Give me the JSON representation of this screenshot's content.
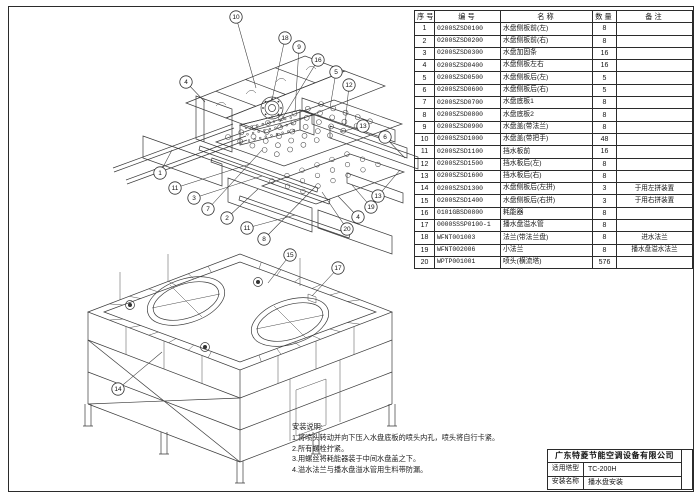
{
  "bom_table": {
    "headers": [
      "序号",
      "编号",
      "名称",
      "数量",
      "备注"
    ],
    "rows": [
      [
        "1",
        "0200SZSD0100",
        "水盘侧板前(左)",
        "8",
        ""
      ],
      [
        "2",
        "0200SZSD0200",
        "水盘侧板前(右)",
        "8",
        ""
      ],
      [
        "3",
        "0200SZSD0300",
        "水盘加固条",
        "16",
        ""
      ],
      [
        "4",
        "0200SZSD0400",
        "水盘侧板左右",
        "16",
        ""
      ],
      [
        "5",
        "0200SZSD0500",
        "水盘侧板后(左)",
        "5",
        ""
      ],
      [
        "6",
        "0200SZSD0600",
        "水盘侧板后(右)",
        "5",
        ""
      ],
      [
        "7",
        "0200SZSD0700",
        "水盘底板1",
        "8",
        ""
      ],
      [
        "8",
        "0200SZSD0800",
        "水盘底板2",
        "8",
        ""
      ],
      [
        "9",
        "0200SZSD0900",
        "水盘盖(带法兰)",
        "8",
        ""
      ],
      [
        "10",
        "0200SZSD1000",
        "水盘盖(带把手)",
        "48",
        ""
      ],
      [
        "11",
        "0200SZSD1100",
        "挡水板前",
        "16",
        ""
      ],
      [
        "12",
        "0200SZSD1500",
        "挡水板后(左)",
        "8",
        ""
      ],
      [
        "13",
        "0200SZSD1600",
        "挡水板后(右)",
        "8",
        ""
      ],
      [
        "14",
        "0200SZSD1300",
        "水盘侧板后(左拼)",
        "3",
        "于用左拼装置"
      ],
      [
        "15",
        "0200SZSD1400",
        "水盘侧板后(右拼)",
        "3",
        "于用右拼装置"
      ],
      [
        "16",
        "0101GBSD0800",
        "耗能器",
        "8",
        ""
      ],
      [
        "17",
        "0000SSSP0100-1",
        "播水盘溢水管",
        "8",
        ""
      ],
      [
        "18",
        "WFNT001003",
        "法兰(带法兰盘)",
        "8",
        "进水法兰"
      ],
      [
        "19",
        "WFNT002006",
        "小法兰",
        "8",
        "播水盘溢水法兰"
      ],
      [
        "20",
        "WPTP001001",
        "喷头(横流塔)",
        "576",
        ""
      ]
    ]
  },
  "notes": {
    "title": "安装说明:",
    "lines": [
      "1.将喷头转动并向下压入水盘底板的喷头内孔，喷头将自行卡紧。",
      "2.所有螺栓拧紧。",
      "3.用螺丝将耗能器装于中间水盘盖之下。",
      "4.溢水法兰与播水盘溢水管用生料带防漏。"
    ]
  },
  "title_block": {
    "company": "广东特菱节能空调设备有限公司",
    "fields": [
      {
        "label": "适用塔型",
        "value": "TC-200H"
      },
      {
        "label": "安装名称",
        "value": "播水盘安装"
      }
    ]
  },
  "balloons": [
    {
      "n": "10",
      "x": 236,
      "y": 17,
      "tx": 256,
      "ty": 88
    },
    {
      "n": "18",
      "x": 285,
      "y": 38,
      "tx": 272,
      "ty": 100
    },
    {
      "n": "9",
      "x": 299,
      "y": 47,
      "tx": 295,
      "ty": 112
    },
    {
      "n": "16",
      "x": 318,
      "y": 60,
      "tx": 280,
      "ty": 122
    },
    {
      "n": "5",
      "x": 336,
      "y": 72,
      "tx": 330,
      "ty": 108
    },
    {
      "n": "12",
      "x": 349,
      "y": 85,
      "tx": 345,
      "ty": 126
    },
    {
      "n": "4",
      "x": 186,
      "y": 82,
      "tx": 205,
      "ty": 102
    },
    {
      "n": "13",
      "x": 363,
      "y": 126,
      "tx": 340,
      "ty": 132
    },
    {
      "n": "6",
      "x": 385,
      "y": 137,
      "tx": 405,
      "ty": 158
    },
    {
      "n": "1",
      "x": 160,
      "y": 173,
      "tx": 172,
      "ty": 150
    },
    {
      "n": "11",
      "x": 175,
      "y": 188,
      "tx": 250,
      "ty": 164
    },
    {
      "n": "3",
      "x": 194,
      "y": 198,
      "tx": 262,
      "ty": 176
    },
    {
      "n": "7",
      "x": 208,
      "y": 209,
      "tx": 262,
      "ty": 150
    },
    {
      "n": "2",
      "x": 227,
      "y": 218,
      "tx": 258,
      "ty": 189
    },
    {
      "n": "11",
      "x": 247,
      "y": 228,
      "tx": 295,
      "ty": 215
    },
    {
      "n": "8",
      "x": 264,
      "y": 239,
      "tx": 316,
      "ty": 186
    },
    {
      "n": "13",
      "x": 378,
      "y": 196,
      "tx": 400,
      "ty": 170
    },
    {
      "n": "19",
      "x": 371,
      "y": 207,
      "tx": 352,
      "ty": 185
    },
    {
      "n": "4",
      "x": 358,
      "y": 217,
      "tx": 338,
      "ty": 196
    },
    {
      "n": "20",
      "x": 347,
      "y": 229,
      "tx": 322,
      "ty": 192
    },
    {
      "n": "15",
      "x": 290,
      "y": 255,
      "tx": 268,
      "ty": 283
    },
    {
      "n": "17",
      "x": 338,
      "y": 268,
      "tx": 312,
      "ty": 296
    },
    {
      "n": "14",
      "x": 118,
      "y": 389,
      "tx": 162,
      "ty": 352
    }
  ]
}
